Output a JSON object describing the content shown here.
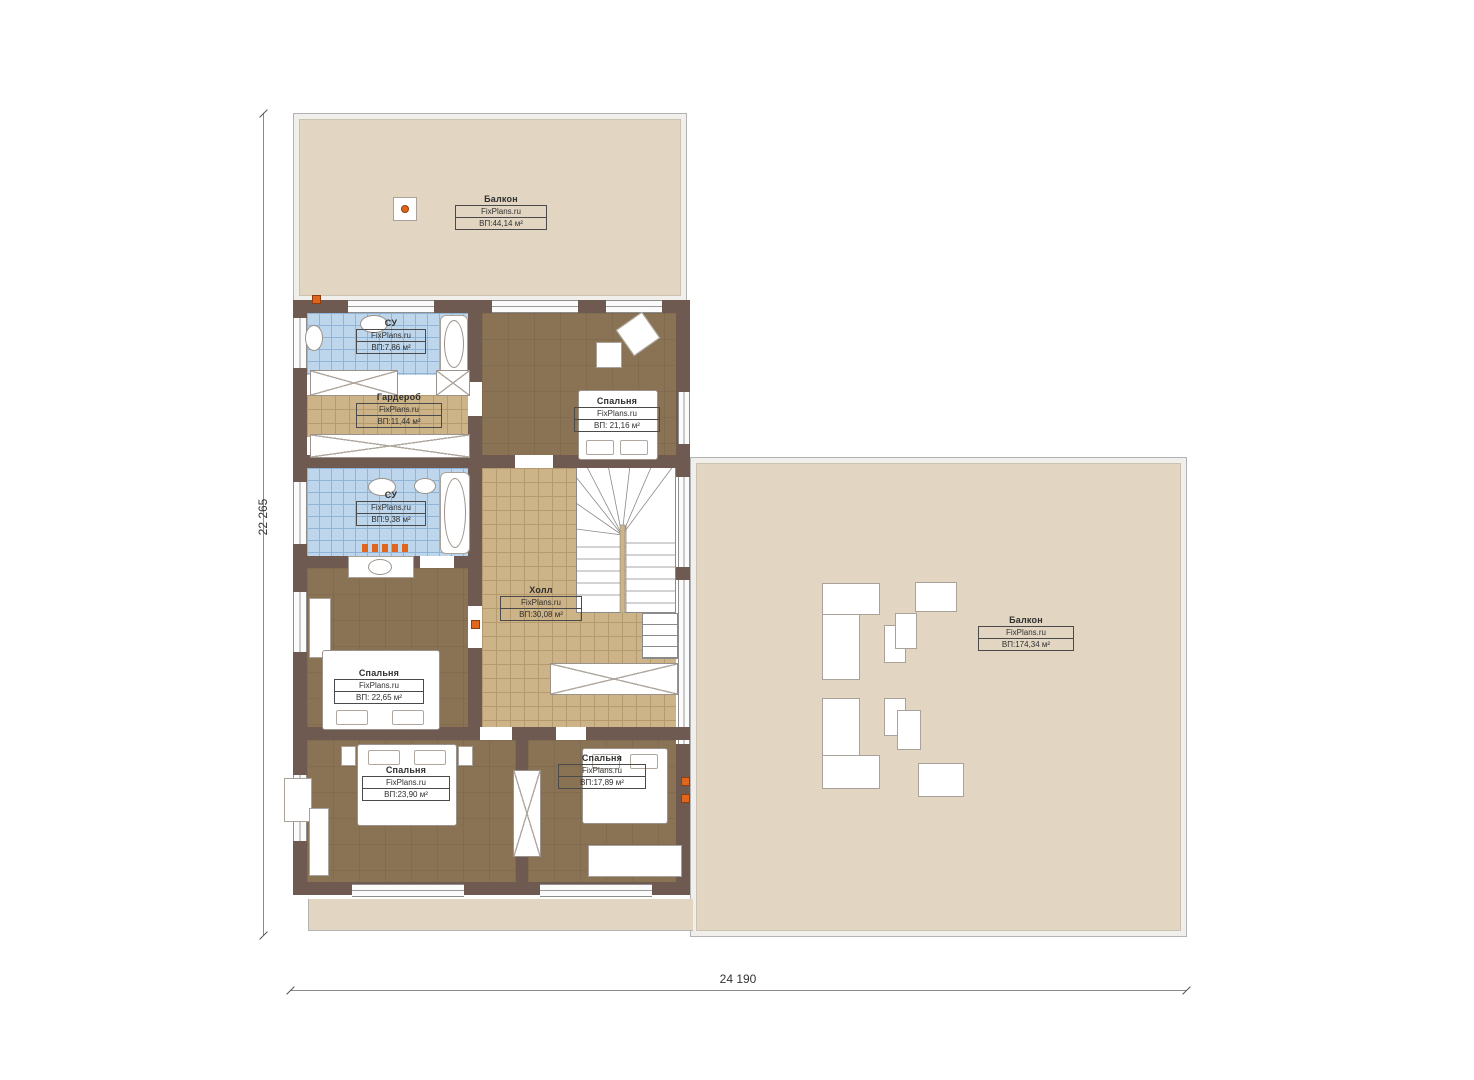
{
  "plan": {
    "site": "FixPlans.ru",
    "dimensions": {
      "height_label": "22 265",
      "width_label": "24 190"
    },
    "rooms": {
      "balcony_top": {
        "name": "Балкон",
        "site": "FixPlans.ru",
        "area": "ВП:44,14 м²"
      },
      "su_top": {
        "name": "СУ",
        "site": "FixPlans.ru",
        "area": "ВП:7,86 м²"
      },
      "wardrobe": {
        "name": "Гардероб",
        "site": "FixPlans.ru",
        "area": "ВП:11,44 м²"
      },
      "bedroom_top_right": {
        "name": "Спальня",
        "site": "FixPlans.ru",
        "area": "ВП: 21,16 м²"
      },
      "su_mid": {
        "name": "СУ",
        "site": "FixPlans.ru",
        "area": "ВП:9,38 м²"
      },
      "hall": {
        "name": "Холл",
        "site": "FixPlans.ru",
        "area": "ВП:30,08 м²"
      },
      "bedroom_mid_left": {
        "name": "Спальня",
        "site": "FixPlans.ru",
        "area": "ВП: 22,65 м²"
      },
      "bedroom_bottom_left": {
        "name": "Спальня",
        "site": "FixPlans.ru",
        "area": "ВП:23,90 м²"
      },
      "bedroom_bottom_right": {
        "name": "Спальня",
        "site": "FixPlans.ru",
        "area": "ВП:17,89 м²"
      },
      "balcony_right": {
        "name": "Балкон",
        "site": "FixPlans.ru",
        "area": "ВП:174,34 м²"
      }
    },
    "colors": {
      "wall": "#6e5a51",
      "balcony_floor": "#e2d6c3",
      "bedroom_floor": "#8a7355",
      "hall_tile": "#cdb388",
      "bath_tile": "#bdd6ec",
      "marker": "#e0661e"
    }
  }
}
